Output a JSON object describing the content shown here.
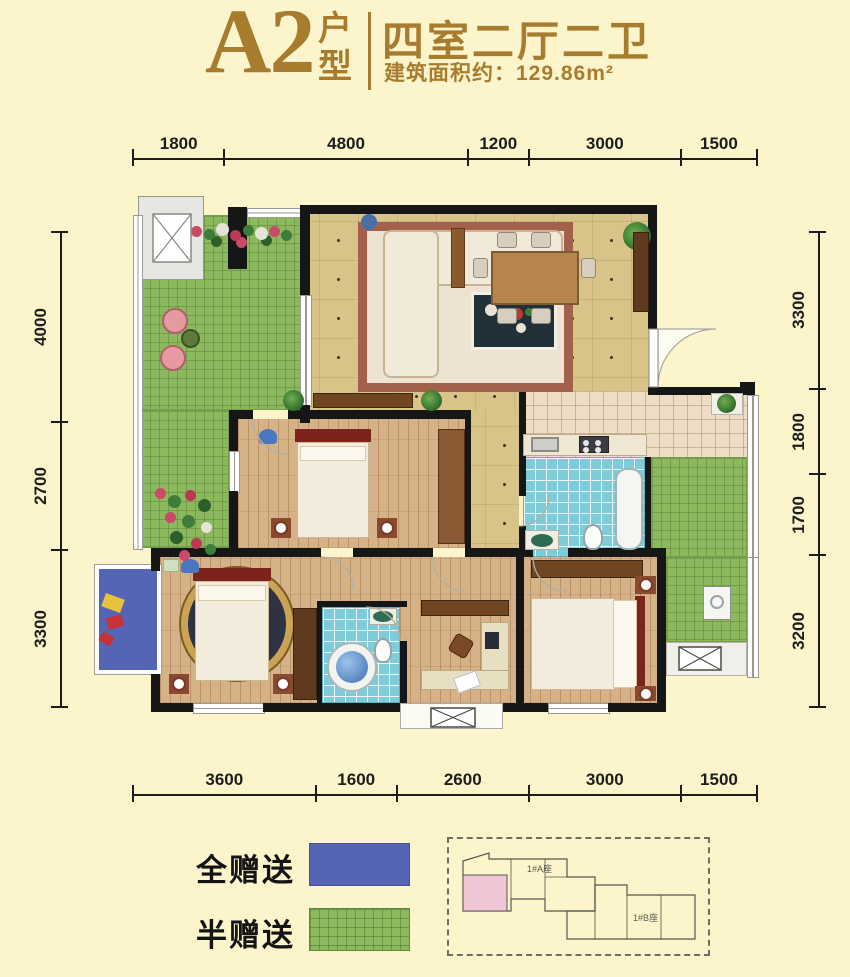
{
  "header": {
    "unit_code": "A2",
    "unit_type_label": "户型",
    "layout_title": "四室二厅二卫",
    "area_text": "建筑面积约：129.86m²",
    "accent_color": "#a87c2e"
  },
  "dimensions": {
    "top": [
      1800,
      4800,
      1200,
      3000,
      1500
    ],
    "bottom": [
      3600,
      1600,
      2600,
      3000,
      1500
    ],
    "left": [
      4000,
      2700,
      3300
    ],
    "right": [
      3300,
      1800,
      1700,
      3200
    ]
  },
  "legend": {
    "items": [
      {
        "label": "全赠送",
        "color": "#5565b5",
        "pattern": "solid"
      },
      {
        "label": "半赠送",
        "color": "#8cb85e",
        "pattern": "grid"
      }
    ]
  },
  "key_plan": {
    "labels": [
      "1#A座",
      "1#B座"
    ],
    "highlight_color": "#eec6d6"
  },
  "plan_colors": {
    "wall": "#161616",
    "public_floor": "#d8c489",
    "bedroom_floor": "#d6b288",
    "bathroom_tile": "#7ecbd9",
    "kitchen_tile": "#ecddc4",
    "gift_full_blue": "#5565b5",
    "gift_half_green": "#8cb85e"
  }
}
